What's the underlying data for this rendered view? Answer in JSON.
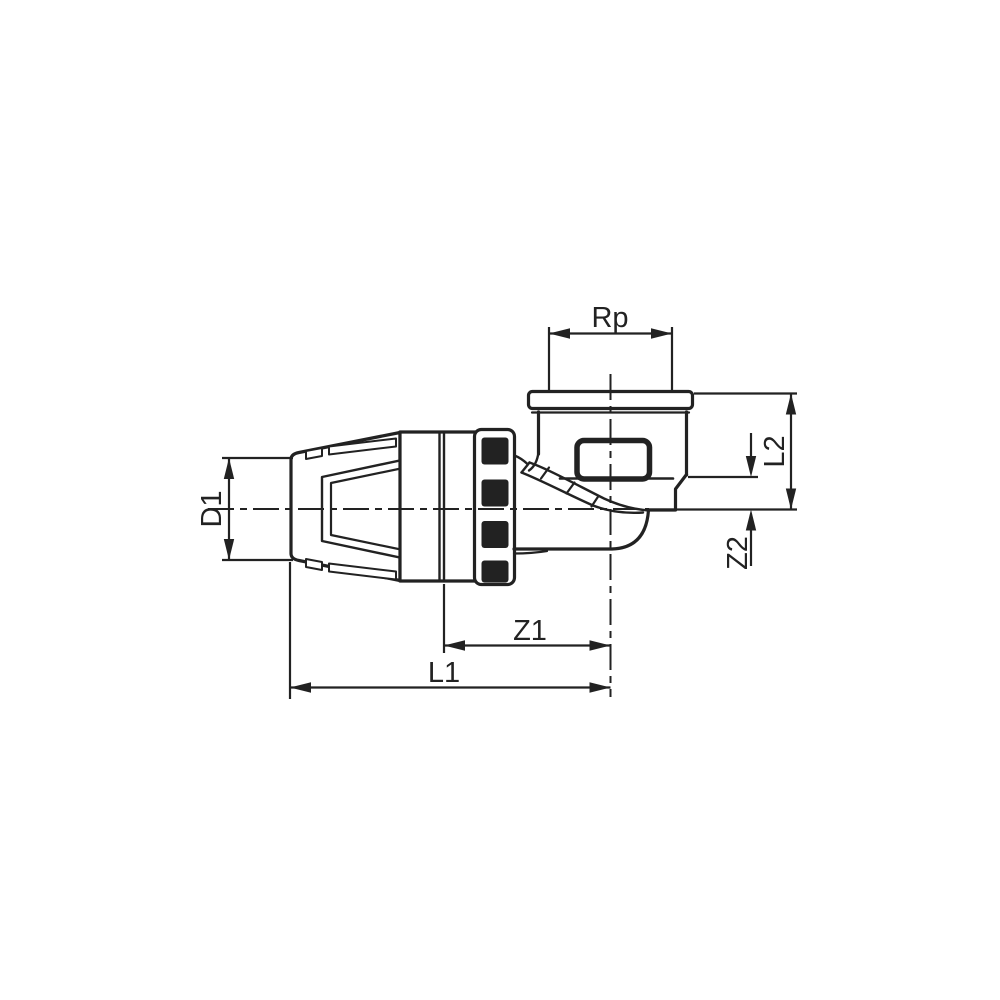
{
  "figure": {
    "type": "technical-drawing",
    "subject": "elbow-fitting-with-compression-end-and-female-thread",
    "background_color": "#ffffff",
    "line_color": "#222222",
    "labels": {
      "rp": "Rp",
      "d1": "D1",
      "l2": "L2",
      "z2": "Z2",
      "z1": "Z1",
      "l1": "L1"
    }
  }
}
